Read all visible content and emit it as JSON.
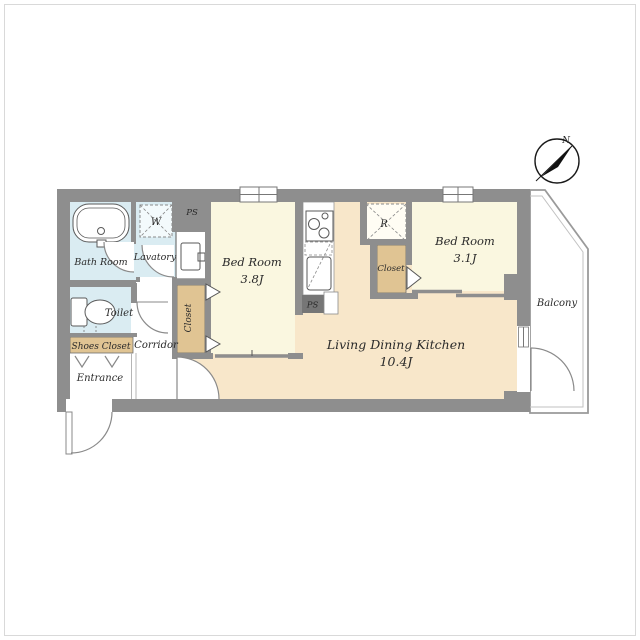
{
  "floorplan": {
    "compass": {
      "north_label": "N"
    },
    "rooms": {
      "bath_room": {
        "label": "Bath Room"
      },
      "lavatory": {
        "label": "Lavatory"
      },
      "toilet": {
        "label": "Toilet"
      },
      "shoes_closet": {
        "label": "Shoes Closet"
      },
      "entrance": {
        "label": "Entrance"
      },
      "corridor": {
        "label": "Corridor"
      },
      "closet_west": {
        "label": "Closet"
      },
      "bedroom_west": {
        "label": "Bed Room",
        "size": "3.8J"
      },
      "living_dining_kitchen": {
        "label": "Living Dining Kitchen",
        "size": "10.4J"
      },
      "closet_east": {
        "label": "Closet"
      },
      "bedroom_east": {
        "label": "Bed Room",
        "size": "3.1J"
      },
      "balcony": {
        "label": "Balcony"
      }
    },
    "fixtures": {
      "washing_machine_label": "W",
      "refrigerator_label": "R",
      "pipe_space_top_label": "PS",
      "pipe_space_kitchen_label": "PS"
    },
    "colors": {
      "wall": "#8e8e8e",
      "bedroom_floor": "#faf7e0",
      "ldk_floor": "#f8e7ca",
      "closet_floor": "#e0c493",
      "wet_area_floor": "#daecf2",
      "balcony_floor": "#ffffff"
    }
  }
}
